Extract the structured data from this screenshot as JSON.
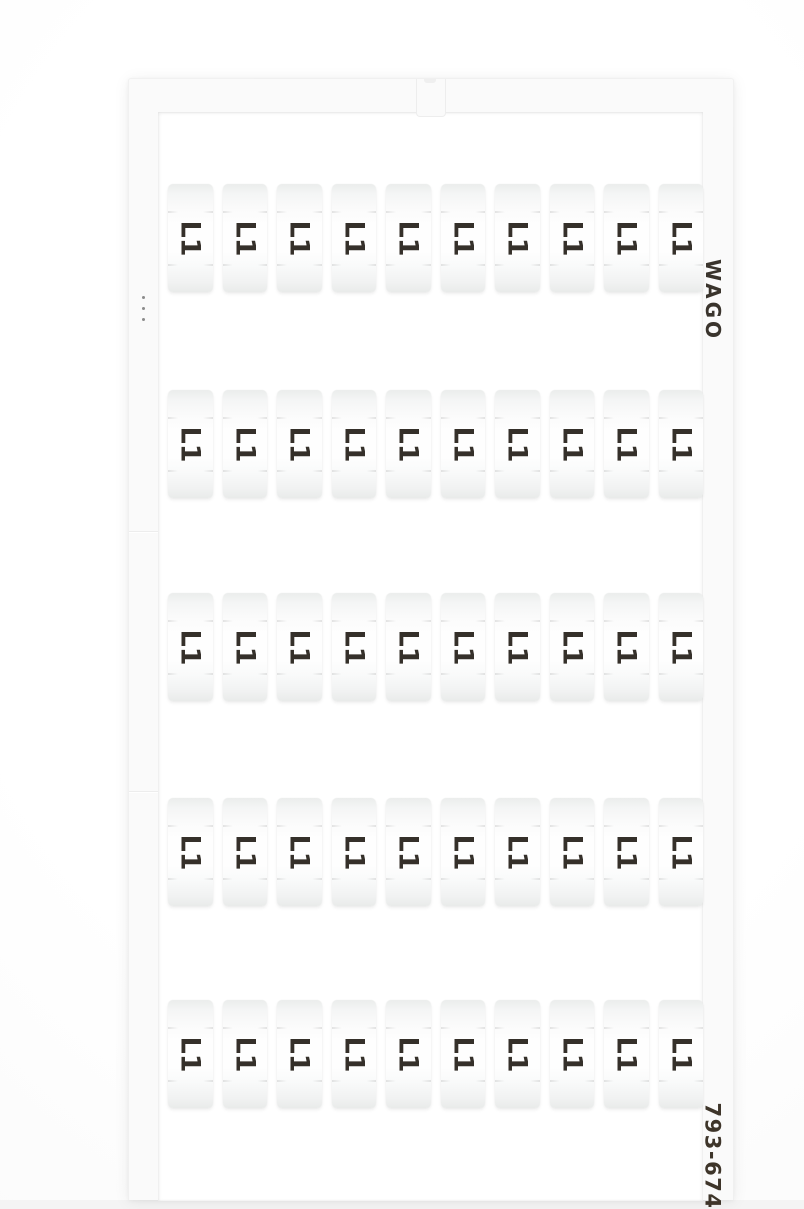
{
  "product": {
    "brand": "WAGO",
    "part_number": "793-674"
  },
  "grid": {
    "rows": 5,
    "columns": 10,
    "label": "L1"
  },
  "colors": {
    "photo_background": "#f4f4f4",
    "card_plastic": "#fafafa",
    "window_white": "#ffffff",
    "tag_fill": "#f4f5f5",
    "print_ink": "#35302a"
  }
}
